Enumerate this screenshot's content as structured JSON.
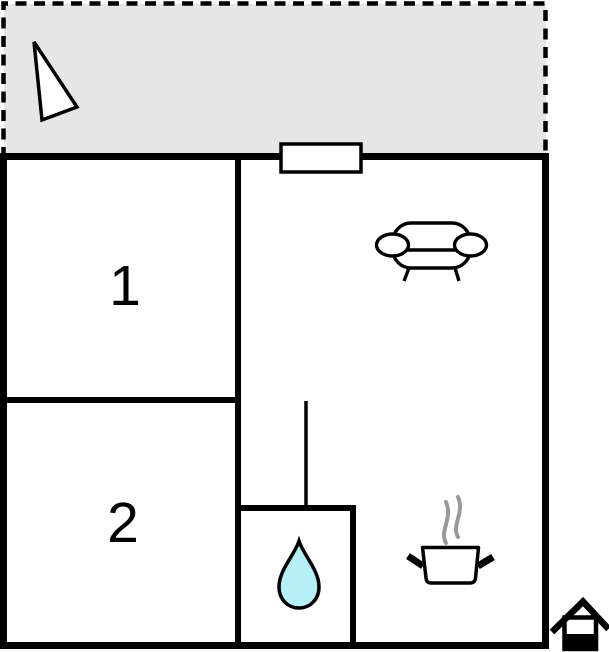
{
  "floorplan": {
    "background_color": "#ffffff",
    "wall_color": "#000000",
    "terrace": {
      "name": "terrace",
      "fill": "#e6e6e6",
      "border_color": "#000000"
    },
    "rooms": [
      {
        "label": "1"
      },
      {
        "label": "2"
      }
    ],
    "icons": {
      "compass": "north-arrow-icon",
      "window": "window-marker",
      "sofa": "sofa-icon",
      "water_drop": "water-drop-icon",
      "cooking_pot": "cooking-pot-icon",
      "steam": "steam-icon",
      "logo": "house-logo-icon"
    },
    "colors": {
      "water_drop_fill": "#b5f0f7",
      "steam": "#999999",
      "icon_fill": "#ffffff"
    }
  }
}
